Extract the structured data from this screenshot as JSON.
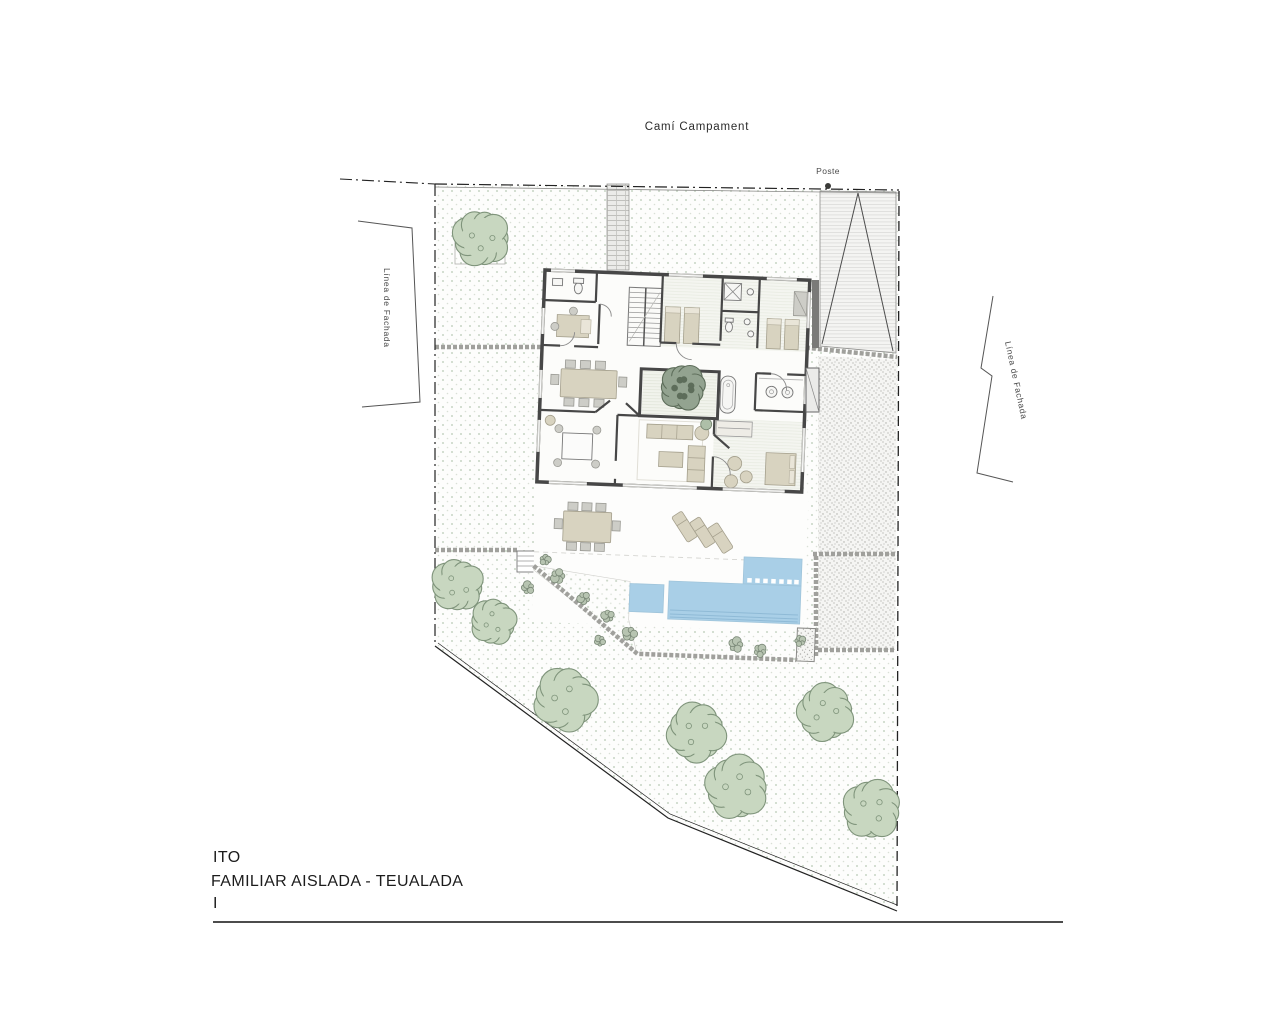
{
  "title": {
    "road_name": "Camí Campament"
  },
  "labels": {
    "post": "Poste",
    "facade_left": "Línea de Fachada",
    "facade_right": "Línea de Fachada"
  },
  "footer": {
    "line1": "ITO",
    "line2": "FAMILIAR AISLADA - TEUALADA",
    "line3": "I"
  },
  "colors": {
    "wall": "#474747",
    "pool": "#a9cfe7",
    "pool_lane": "#8fbad6",
    "furniture_tan": "#d8d3c0",
    "ground_dot": "#c9d5c6",
    "tree_fill": "#c8d7c0",
    "tree_outline": "#7f947b",
    "courtyard_tree_fill": "#93a390",
    "courtyard_tree_outline": "#5d6d5a",
    "shrub_fill": "#b7c4b1",
    "shrub_outline": "#7a8877"
  },
  "trees": [
    {
      "x": 482,
      "y": 238,
      "r": 26,
      "kind": "light"
    },
    {
      "x": 458,
      "y": 585,
      "r": 24,
      "kind": "light"
    },
    {
      "x": 494,
      "y": 622,
      "r": 21,
      "kind": "light"
    },
    {
      "x": 566,
      "y": 700,
      "r": 29,
      "kind": "light"
    },
    {
      "x": 697,
      "y": 733,
      "r": 27,
      "kind": "light"
    },
    {
      "x": 826,
      "y": 713,
      "r": 26,
      "kind": "light"
    },
    {
      "x": 737,
      "y": 788,
      "r": 29,
      "kind": "light"
    },
    {
      "x": 872,
      "y": 810,
      "r": 27,
      "kind": "light"
    },
    {
      "x": 683,
      "y": 388,
      "r": 21,
      "kind": "dark"
    }
  ],
  "shrubs": [
    {
      "x": 558,
      "y": 576,
      "r": 8
    },
    {
      "x": 584,
      "y": 598,
      "r": 7
    },
    {
      "x": 608,
      "y": 616,
      "r": 7
    },
    {
      "x": 630,
      "y": 634,
      "r": 8
    },
    {
      "x": 600,
      "y": 641,
      "r": 6
    },
    {
      "x": 528,
      "y": 588,
      "r": 7
    },
    {
      "x": 736,
      "y": 645,
      "r": 8
    },
    {
      "x": 760,
      "y": 651,
      "r": 7
    },
    {
      "x": 800,
      "y": 641,
      "r": 6
    },
    {
      "x": 545,
      "y": 560,
      "r": 6
    }
  ]
}
